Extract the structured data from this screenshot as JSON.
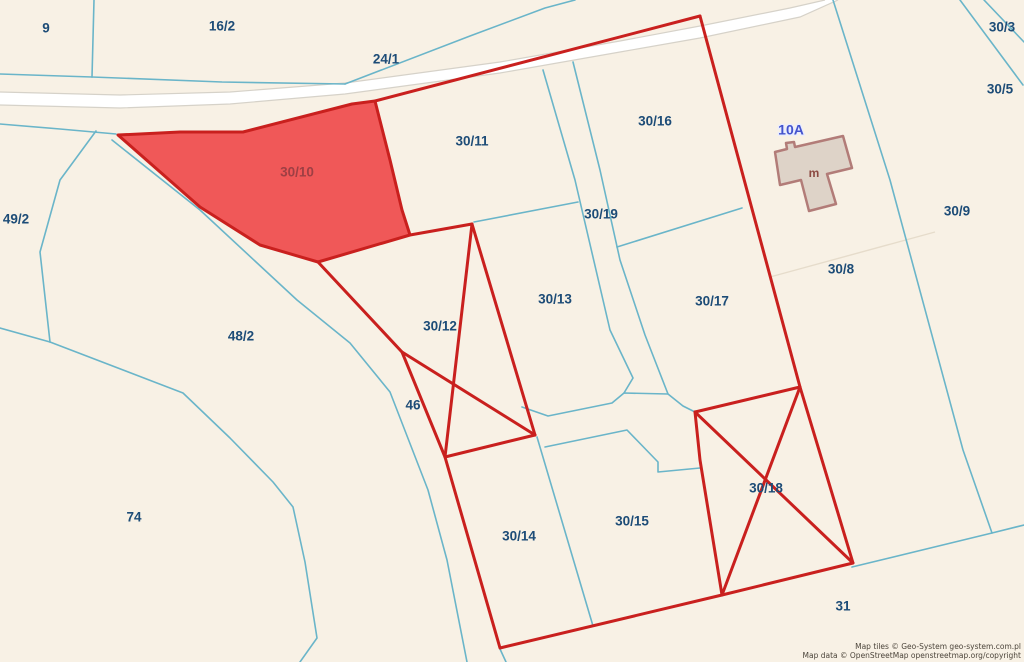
{
  "map": {
    "colors": {
      "background": "#f8f1e5",
      "blue_boundary": "#6ab5c9",
      "faint_boundary": "#e6dccb",
      "red_boundary": "#c9201e",
      "red_parcel_fill": "#f05858",
      "red_parcel_label": "#9e3f44",
      "road_fill": "#ffffff",
      "road_edge": "#d6d2c9",
      "building_fill": "#ded3c8",
      "building_stroke": "#b27c78",
      "label_navy": "#1d4c77",
      "address_blue": "#4453cc",
      "building_label": "#8c4a42"
    },
    "road": {
      "top_edge": [
        [
          0,
          92
        ],
        [
          120,
          95
        ],
        [
          230,
          92
        ],
        [
          345,
          83
        ],
        [
          500,
          62
        ],
        [
          620,
          41
        ],
        [
          700,
          26
        ],
        [
          790,
          8
        ],
        [
          825,
          0
        ]
      ],
      "bottom_edge": [
        [
          0,
          105
        ],
        [
          120,
          108
        ],
        [
          230,
          104
        ],
        [
          345,
          94
        ],
        [
          500,
          73
        ],
        [
          620,
          52
        ],
        [
          700,
          38
        ],
        [
          800,
          17
        ],
        [
          838,
          0
        ]
      ]
    },
    "blue_lines": [
      {
        "pts": [
          [
            0,
            74
          ],
          [
            92,
            77
          ]
        ]
      },
      {
        "pts": [
          [
            94,
            0
          ],
          [
            92,
            77
          ]
        ]
      },
      {
        "pts": [
          [
            92,
            77
          ],
          [
            222,
            82
          ],
          [
            345,
            84
          ]
        ]
      },
      {
        "pts": [
          [
            345,
            84
          ],
          [
            470,
            36
          ],
          [
            545,
            8
          ],
          [
            575,
            0
          ]
        ]
      },
      {
        "pts": [
          [
            0,
            124
          ],
          [
            60,
            129
          ],
          [
            116,
            134
          ]
        ]
      },
      {
        "pts": [
          [
            96,
            131
          ],
          [
            60,
            180
          ],
          [
            40,
            252
          ],
          [
            50,
            342
          ]
        ]
      },
      {
        "pts": [
          [
            0,
            328
          ],
          [
            50,
            342
          ]
        ]
      },
      {
        "pts": [
          [
            50,
            342
          ],
          [
            183,
            393
          ],
          [
            230,
            438
          ],
          [
            273,
            482
          ],
          [
            293,
            507
          ],
          [
            305,
            562
          ],
          [
            317,
            638
          ],
          [
            300,
            662
          ]
        ]
      },
      {
        "pts": [
          [
            112,
            140
          ],
          [
            200,
            210
          ],
          [
            297,
            300
          ],
          [
            350,
            343
          ],
          [
            390,
            392
          ],
          [
            428,
            490
          ],
          [
            447,
            560
          ],
          [
            467,
            662
          ]
        ]
      },
      {
        "pts": [
          [
            474,
            222
          ],
          [
            578,
            202
          ]
        ]
      },
      {
        "pts": [
          [
            543,
            70
          ],
          [
            575,
            180
          ],
          [
            610,
            330
          ],
          [
            633,
            378
          ],
          [
            624,
            393
          ]
        ]
      },
      {
        "pts": [
          [
            573,
            62
          ],
          [
            600,
            170
          ],
          [
            620,
            260
          ],
          [
            645,
            335
          ],
          [
            668,
            394
          ]
        ]
      },
      {
        "pts": [
          [
            522,
            407
          ],
          [
            548,
            416
          ],
          [
            612,
            403
          ],
          [
            624,
            393
          ],
          [
            668,
            394
          ],
          [
            683,
            406
          ],
          [
            695,
            412
          ]
        ]
      },
      {
        "pts": [
          [
            545,
            447
          ],
          [
            627,
            430
          ],
          [
            658,
            462
          ],
          [
            658,
            472
          ],
          [
            700,
            468
          ]
        ]
      },
      {
        "pts": [
          [
            537,
            437
          ],
          [
            593,
            626
          ]
        ]
      },
      {
        "pts": [
          [
            617,
            247
          ],
          [
            742,
            208
          ]
        ]
      },
      {
        "pts": [
          [
            833,
            0
          ],
          [
            890,
            180
          ],
          [
            963,
            450
          ],
          [
            992,
            533
          ]
        ]
      },
      {
        "pts": [
          [
            852,
            567
          ],
          [
            992,
            533
          ],
          [
            1024,
            525
          ]
        ]
      },
      {
        "pts": [
          [
            960,
            0
          ],
          [
            1023,
            85
          ]
        ]
      },
      {
        "pts": [
          [
            984,
            0
          ],
          [
            1024,
            42
          ]
        ]
      },
      {
        "pts": [
          [
            500,
            649
          ],
          [
            506,
            662
          ]
        ]
      }
    ],
    "faint_lines": [
      {
        "pts": [
          [
            770,
            277
          ],
          [
            935,
            232
          ]
        ]
      }
    ],
    "red_lines": [
      {
        "pts": [
          [
            700,
            16
          ],
          [
            375,
            101
          ]
        ],
        "w": 3
      },
      {
        "pts": [
          [
            700,
            16
          ],
          [
            800,
            387
          ],
          [
            853,
            563
          ],
          [
            722,
            595
          ],
          [
            500,
            648
          ],
          [
            445,
            457
          ],
          [
            402,
            352
          ],
          [
            318,
            262
          ]
        ],
        "w": 3
      },
      {
        "pts": [
          [
            410,
            235
          ],
          [
            472,
            224
          ]
        ],
        "w": 3
      },
      {
        "pts": [
          [
            472,
            224
          ],
          [
            445,
            457
          ]
        ],
        "w": 3
      },
      {
        "pts": [
          [
            472,
            224
          ],
          [
            535,
            435
          ]
        ],
        "w": 3
      },
      {
        "pts": [
          [
            445,
            457
          ],
          [
            535,
            435
          ]
        ],
        "w": 3
      },
      {
        "pts": [
          [
            402,
            352
          ],
          [
            535,
            435
          ]
        ],
        "w": 3
      },
      {
        "pts": [
          [
            695,
            412
          ],
          [
            800,
            387
          ]
        ],
        "w": 3
      },
      {
        "pts": [
          [
            695,
            412
          ],
          [
            700,
            460
          ],
          [
            722,
            595
          ]
        ],
        "w": 3
      },
      {
        "pts": [
          [
            695,
            412
          ],
          [
            853,
            563
          ]
        ],
        "w": 3
      },
      {
        "pts": [
          [
            800,
            387
          ],
          [
            722,
            595
          ]
        ],
        "w": 3
      },
      {
        "pts": [
          [
            321,
            266
          ],
          [
            404,
            355
          ]
        ],
        "w": 1.5
      }
    ],
    "red_parcel": {
      "id": "30/10",
      "pts": [
        [
          118,
          135
        ],
        [
          180,
          132
        ],
        [
          243,
          132
        ],
        [
          352,
          104
        ],
        [
          375,
          101
        ],
        [
          390,
          160
        ],
        [
          402,
          210
        ],
        [
          410,
          235
        ],
        [
          318,
          262
        ],
        [
          260,
          245
        ],
        [
          200,
          207
        ]
      ]
    },
    "building": {
      "pts": [
        [
          775,
          152
        ],
        [
          787,
          149
        ],
        [
          786,
          143
        ],
        [
          794,
          142
        ],
        [
          795,
          147
        ],
        [
          843,
          136
        ],
        [
          852,
          168
        ],
        [
          827,
          174
        ],
        [
          836,
          204
        ],
        [
          809,
          211
        ],
        [
          801,
          180
        ],
        [
          780,
          185
        ]
      ]
    },
    "labels": [
      {
        "t": "9",
        "x": 46,
        "y": 29
      },
      {
        "t": "16/2",
        "x": 222,
        "y": 27
      },
      {
        "t": "24/1",
        "x": 386,
        "y": 60
      },
      {
        "t": "30/11",
        "x": 472,
        "y": 142
      },
      {
        "t": "30/16",
        "x": 655,
        "y": 122
      },
      {
        "t": "30/3",
        "x": 1002,
        "y": 28
      },
      {
        "t": "30/5",
        "x": 1000,
        "y": 90
      },
      {
        "t": "30/9",
        "x": 957,
        "y": 212
      },
      {
        "t": "30/8",
        "x": 841,
        "y": 270
      },
      {
        "t": "49/2",
        "x": 16,
        "y": 220
      },
      {
        "t": "30/19",
        "x": 601,
        "y": 215
      },
      {
        "t": "30/13",
        "x": 555,
        "y": 300
      },
      {
        "t": "30/17",
        "x": 712,
        "y": 302
      },
      {
        "t": "48/2",
        "x": 241,
        "y": 337
      },
      {
        "t": "30/12",
        "x": 440,
        "y": 327
      },
      {
        "t": "46",
        "x": 413,
        "y": 406
      },
      {
        "t": "74",
        "x": 134,
        "y": 518
      },
      {
        "t": "30/14",
        "x": 519,
        "y": 537
      },
      {
        "t": "30/15",
        "x": 632,
        "y": 522
      },
      {
        "t": "30/18",
        "x": 766,
        "y": 489
      },
      {
        "t": "31",
        "x": 843,
        "y": 607
      },
      {
        "t": "30/10",
        "x": 297,
        "y": 173,
        "c": "#9e3f44"
      },
      {
        "t": "m",
        "x": 814,
        "y": 174,
        "c": "#8c4a42",
        "s": 12
      },
      {
        "t": "10A",
        "x": 791,
        "y": 131,
        "c": "#4453cc",
        "s": 14,
        "halo": true
      }
    ],
    "attribution": {
      "line1": "Map tiles © Geo-System geo-system.com.pl",
      "line2": "Map data © OpenStreetMap openstreetmap.org/copyright"
    }
  }
}
